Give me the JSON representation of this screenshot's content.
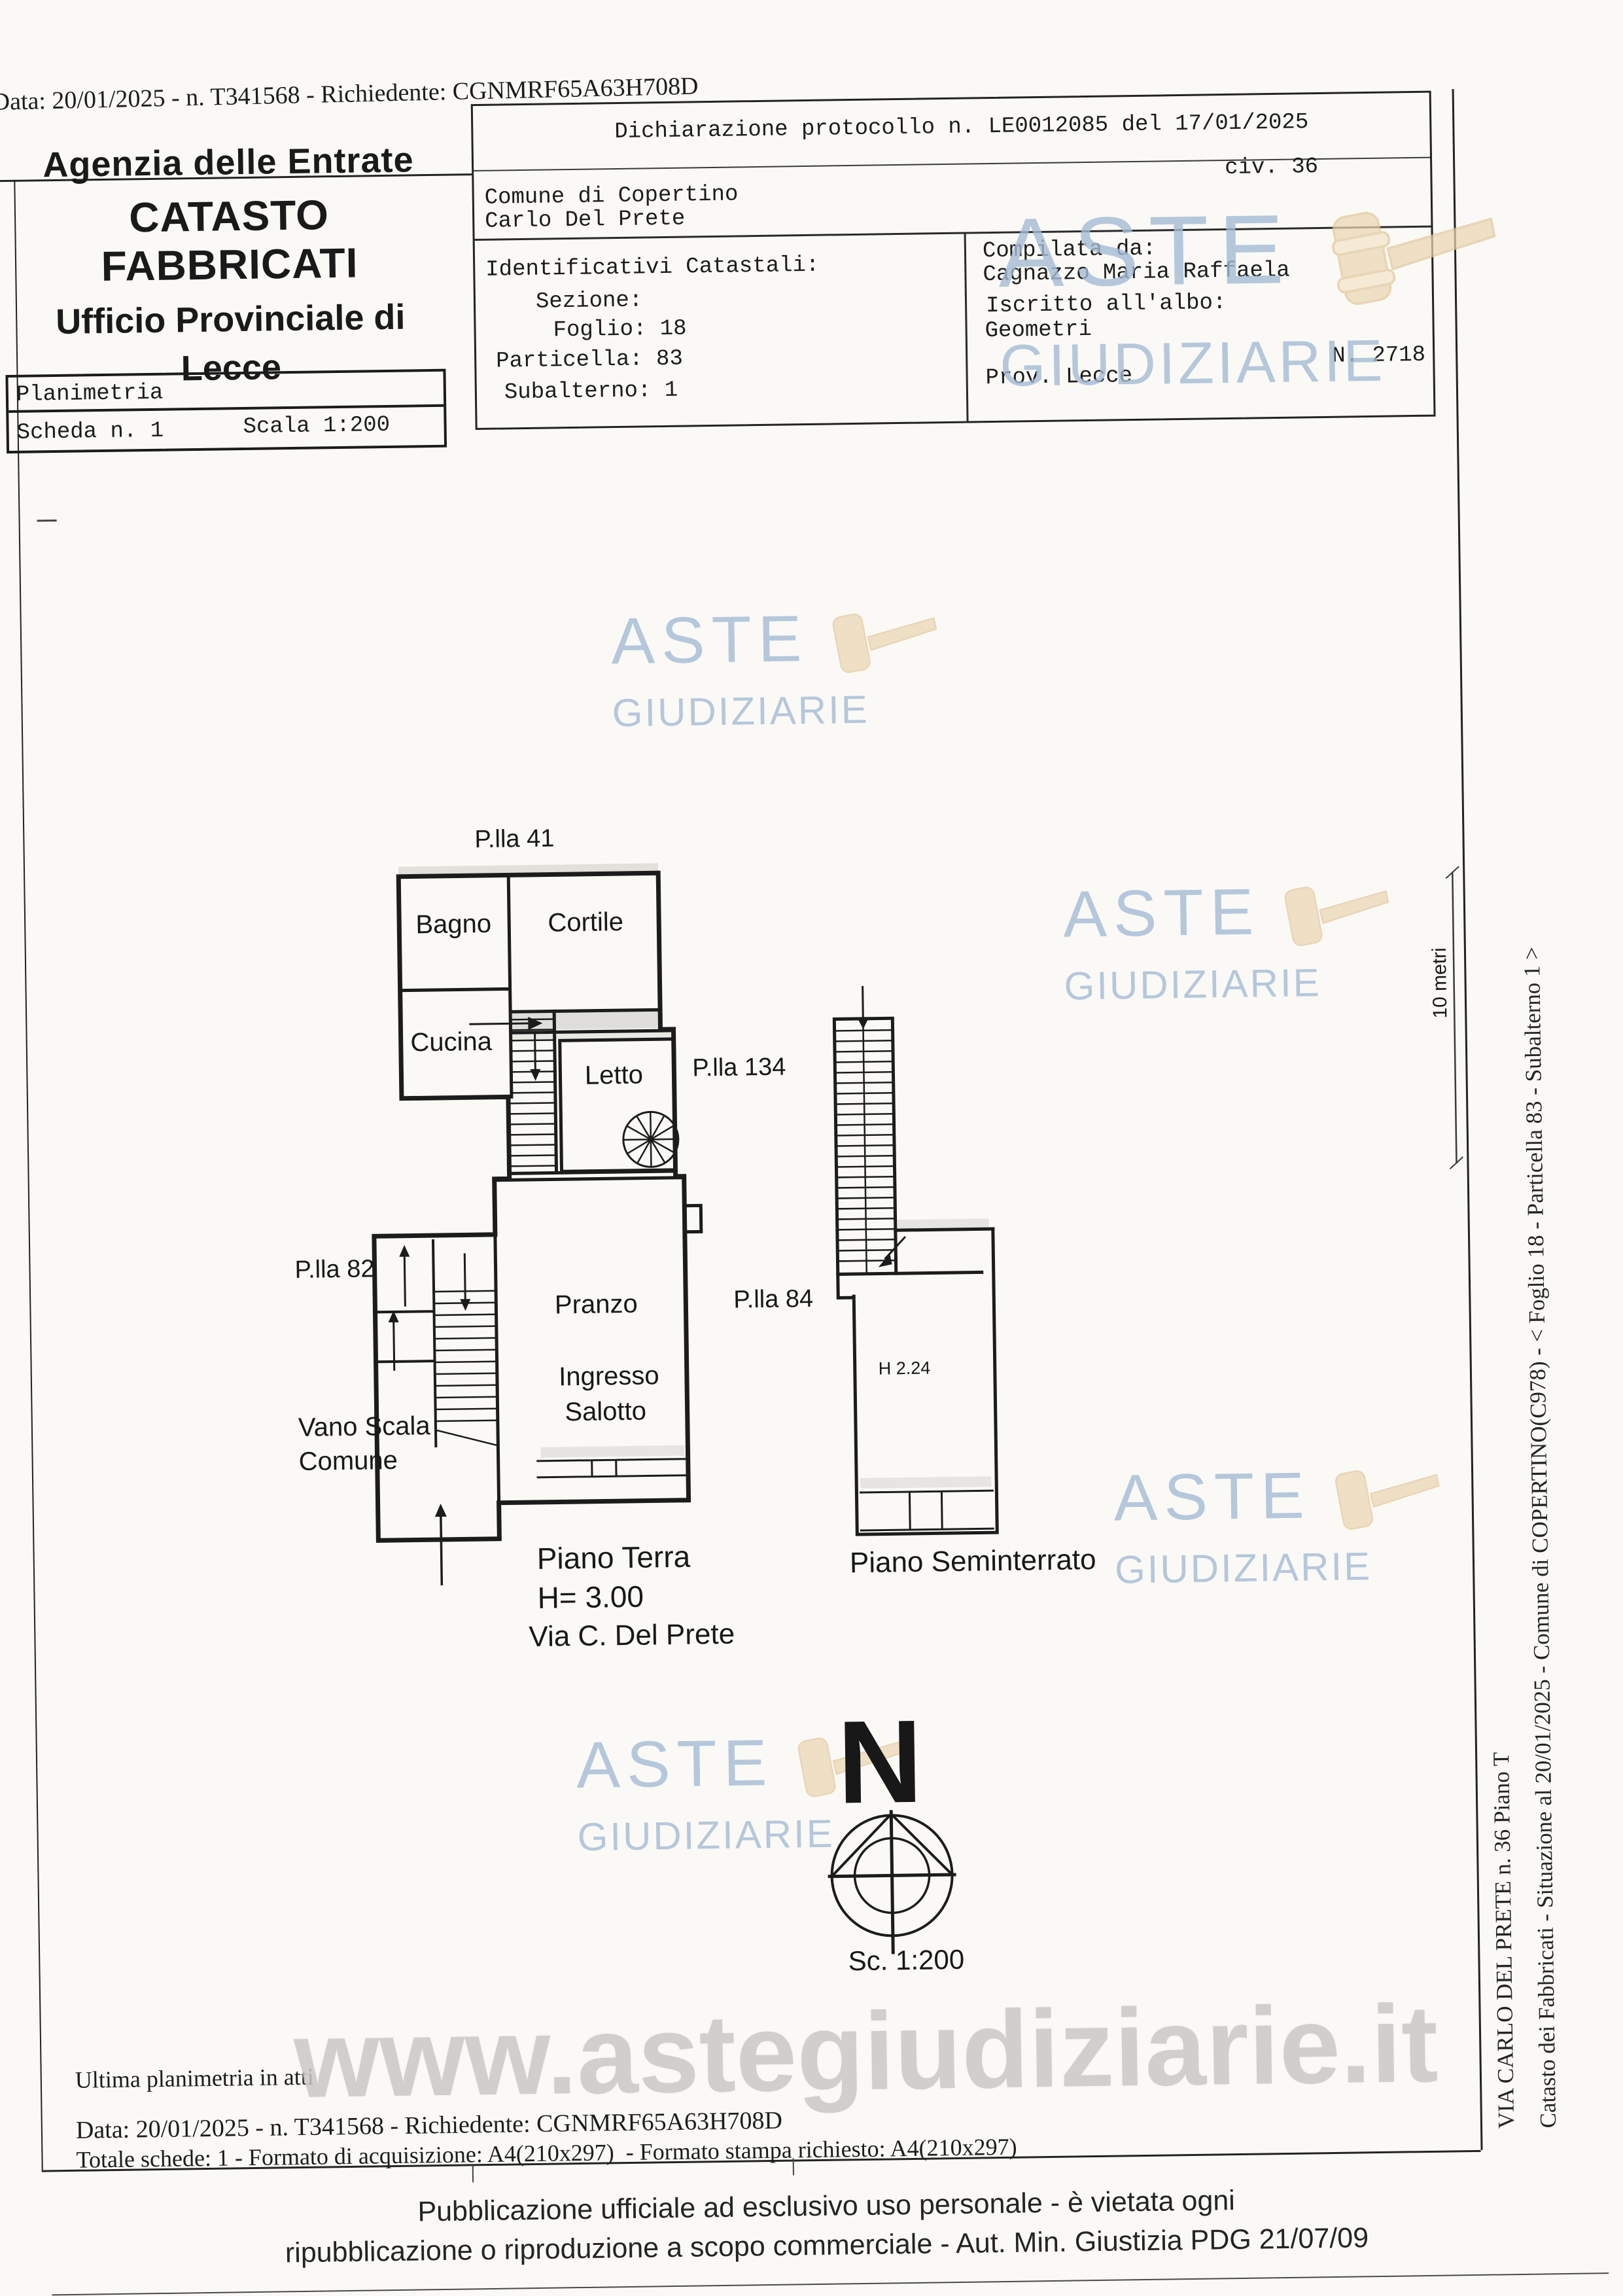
{
  "meta_top": {
    "request_line": "Data: 20/01/2025 - n. T341568 - Richiedente: CGNMRF65A63H708D"
  },
  "agency": {
    "line1": "Agenzia delle Entrate",
    "line2": "CATASTO FABBRICATI",
    "line3": "Ufficio Provinciale di",
    "line4": "Lecce"
  },
  "sheet_box": {
    "planimetria": "Planimetria",
    "scheda": "Scheda n. 1",
    "scala": "Scala 1:200"
  },
  "declaration": {
    "protocol": "Dichiarazione protocollo n. LE0012085 del 17/01/2025",
    "comune": "Comune di Copertino",
    "civ": "civ. 36",
    "intestatario": "Carlo Del Prete",
    "identificativi_title": "Identificativi Catastali:",
    "sezione": "Sezione:",
    "foglio": "Foglio: 18",
    "particella": "Particella: 83",
    "subalterno": "Subalterno: 1",
    "compilata_label": "Compilata da:",
    "compilata_name": "Cagnazzo Maria Raffaela",
    "albo_label": "Iscritto all'albo:",
    "albo_value": "Geometri",
    "prov": "Prov. Lecce",
    "albo_n": "N. 2718"
  },
  "plan": {
    "p41": "P.lla 41",
    "p134": "P.lla 134",
    "p82": "P.lla 82",
    "p84": "P.lla 84",
    "bagno": "Bagno",
    "cortile": "Cortile",
    "cucina": "Cucina",
    "letto": "Letto",
    "pranzo": "Pranzo",
    "ingresso": "Ingresso",
    "salotto": "Salotto",
    "vano1": "Vano Scala",
    "vano2": "Comune",
    "pt_title": "Piano Terra",
    "pt_h": "H= 3.00",
    "pt_via": "Via C. Del Prete",
    "sem_title": "Piano Seminterrato",
    "sem_h": "H 2.24",
    "north": "N",
    "scale": "Sc. 1:200",
    "bar": "10 metri"
  },
  "vertical": {
    "line1": "Catasto dei Fabbricati - Situazione al 20/01/2025 - Comune di COPERTINO(C978) - < Foglio 18 - Particella 83 - Subalterno 1 >",
    "line2": "VIA CARLO DEL PRETE n. 36 Piano T"
  },
  "bottom": {
    "ultima": "Ultima planimetria in atti",
    "data_line": "Data: 20/01/2025 - n. T341568 - Richiedente: CGNMRF65A63H708D",
    "totale": "Totale schede: 1 - Formato di acquisizione: A4(210x297)  - Formato stampa richiesto: A4(210x297)"
  },
  "footer": {
    "line1": "Pubblicazione ufficiale ad esclusivo uso personale - è vietata ogni",
    "line2": "ripubblicazione o riproduzione a scopo commerciale - Aut. Min. Giustizia PDG 21/07/09"
  },
  "watermark": {
    "word1": "ASTE",
    "word2": "GIUDIZIARIE",
    "url": "www.astegiudiziarie.it",
    "blue": "#a4bbd5",
    "gavel": "#ead5b2",
    "url_gray": "#c9c8c4"
  }
}
